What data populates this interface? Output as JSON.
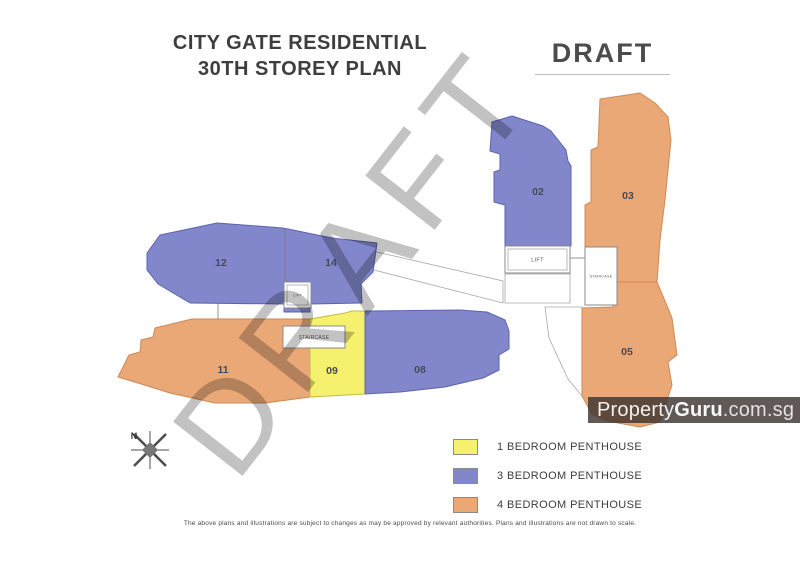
{
  "title": {
    "line1": "CITY GATE RESIDENTIAL",
    "line2": "30TH STOREY PLAN"
  },
  "draft_label": "DRAFT",
  "diagonal_watermark": "DRAFT",
  "brand": {
    "name": "PropertyGuru.com.sg",
    "part1": "Property",
    "part2": "Guru",
    "part3": ".com.sg"
  },
  "compass": {
    "north_label": "N"
  },
  "legend": {
    "items": [
      {
        "label": "1 BEDROOM PENTHOUSE",
        "color": "#f5f06e"
      },
      {
        "label": "3 BEDROOM PENTHOUSE",
        "color": "#8187ca"
      },
      {
        "label": "4 BEDROOM PENTHOUSE",
        "color": "#eaa876"
      }
    ]
  },
  "disclaimer": "The above plans and illustrations are subject to changes as may be approved by relevant authorities. Plans and illustrations are not drawn to scale.",
  "plan": {
    "unit_types": {
      "1br": {
        "fill": "#f5f06e",
        "stroke": "#c2bc45"
      },
      "3br": {
        "fill": "#8187ca",
        "stroke": "#5d63ad"
      },
      "4br": {
        "fill": "#eaa876",
        "stroke": "#cd8a55"
      }
    },
    "buildings": [
      {
        "name": "12-14",
        "type": "3br",
        "points": "147,253 160,235 217,223 283,228 332,238 377,243 373,272 361,284 362,303 310,304 310,312 284,312 284,304 190,303 158,284 147,270"
      },
      {
        "name": "11",
        "type": "4br",
        "points": "118,377 129,355 140,352 141,340 153,337 155,328 192,319 310,319 310,397 265,403 215,403 170,393 138,383"
      },
      {
        "name": "09",
        "type": "1br",
        "points": "310,319 345,313 352,311 365,311 365,394 310,397"
      },
      {
        "name": "08",
        "type": "3br",
        "points": "365,311 460,310 487,312 505,320 509,331 509,349 499,355 499,370 483,378 445,387 400,392 365,394"
      },
      {
        "name": "02",
        "type": "3br",
        "points": "492,122 512,116 543,126 551,131 566,150 568,161 571,166 571,246 505,246 505,205 494,202 494,172 500,170 500,154 490,151"
      },
      {
        "name": "03",
        "type": "4br",
        "points": "600,99 640,93 655,103 668,117 671,140 665,200 660,240 657,282 617,282 617,247 585,247 585,205 591,202 591,150 598,147"
      },
      {
        "name": "05",
        "type": "4br",
        "points": "582,308 613,307 613,282 657,282 672,318 677,355 668,362 672,385 660,422 640,427 607,421 592,414 582,396"
      }
    ],
    "dividers": [
      {
        "points": "285,228 285,303"
      },
      {
        "points": "218,303 218,319"
      },
      {
        "points": "570,258 585,258"
      }
    ],
    "walkways": [
      {
        "points": "368,250 503,281 503,303 366,268"
      },
      {
        "points": "505,274 570,274 570,303 505,303"
      },
      {
        "points": "545,307 582,307 582,396 568,379 549,338"
      }
    ],
    "facilities": [
      {
        "label": "LIFT",
        "x": 284,
        "y": 282,
        "w": 27,
        "h": 26,
        "font": 3.6,
        "inner": true
      },
      {
        "label": "STAIRCASE",
        "x": 283,
        "y": 326,
        "w": 62,
        "h": 22,
        "font": 5,
        "inner": false
      },
      {
        "label": "LIFT",
        "x": 505,
        "y": 246,
        "w": 65,
        "h": 27,
        "font": 5.5,
        "inner": true
      },
      {
        "label": "STAIRCASE",
        "x": 585,
        "y": 247,
        "w": 32,
        "h": 58,
        "font": 3.6,
        "inner": false
      }
    ],
    "unit_labels": [
      {
        "text": "12",
        "x": 221,
        "y": 266
      },
      {
        "text": "14",
        "x": 331,
        "y": 266
      },
      {
        "text": "02",
        "x": 538,
        "y": 195
      },
      {
        "text": "03",
        "x": 628,
        "y": 199
      },
      {
        "text": "11",
        "x": 223,
        "y": 373
      },
      {
        "text": "09",
        "x": 332,
        "y": 374
      },
      {
        "text": "08",
        "x": 420,
        "y": 373
      },
      {
        "text": "05",
        "x": 627,
        "y": 355
      }
    ]
  }
}
